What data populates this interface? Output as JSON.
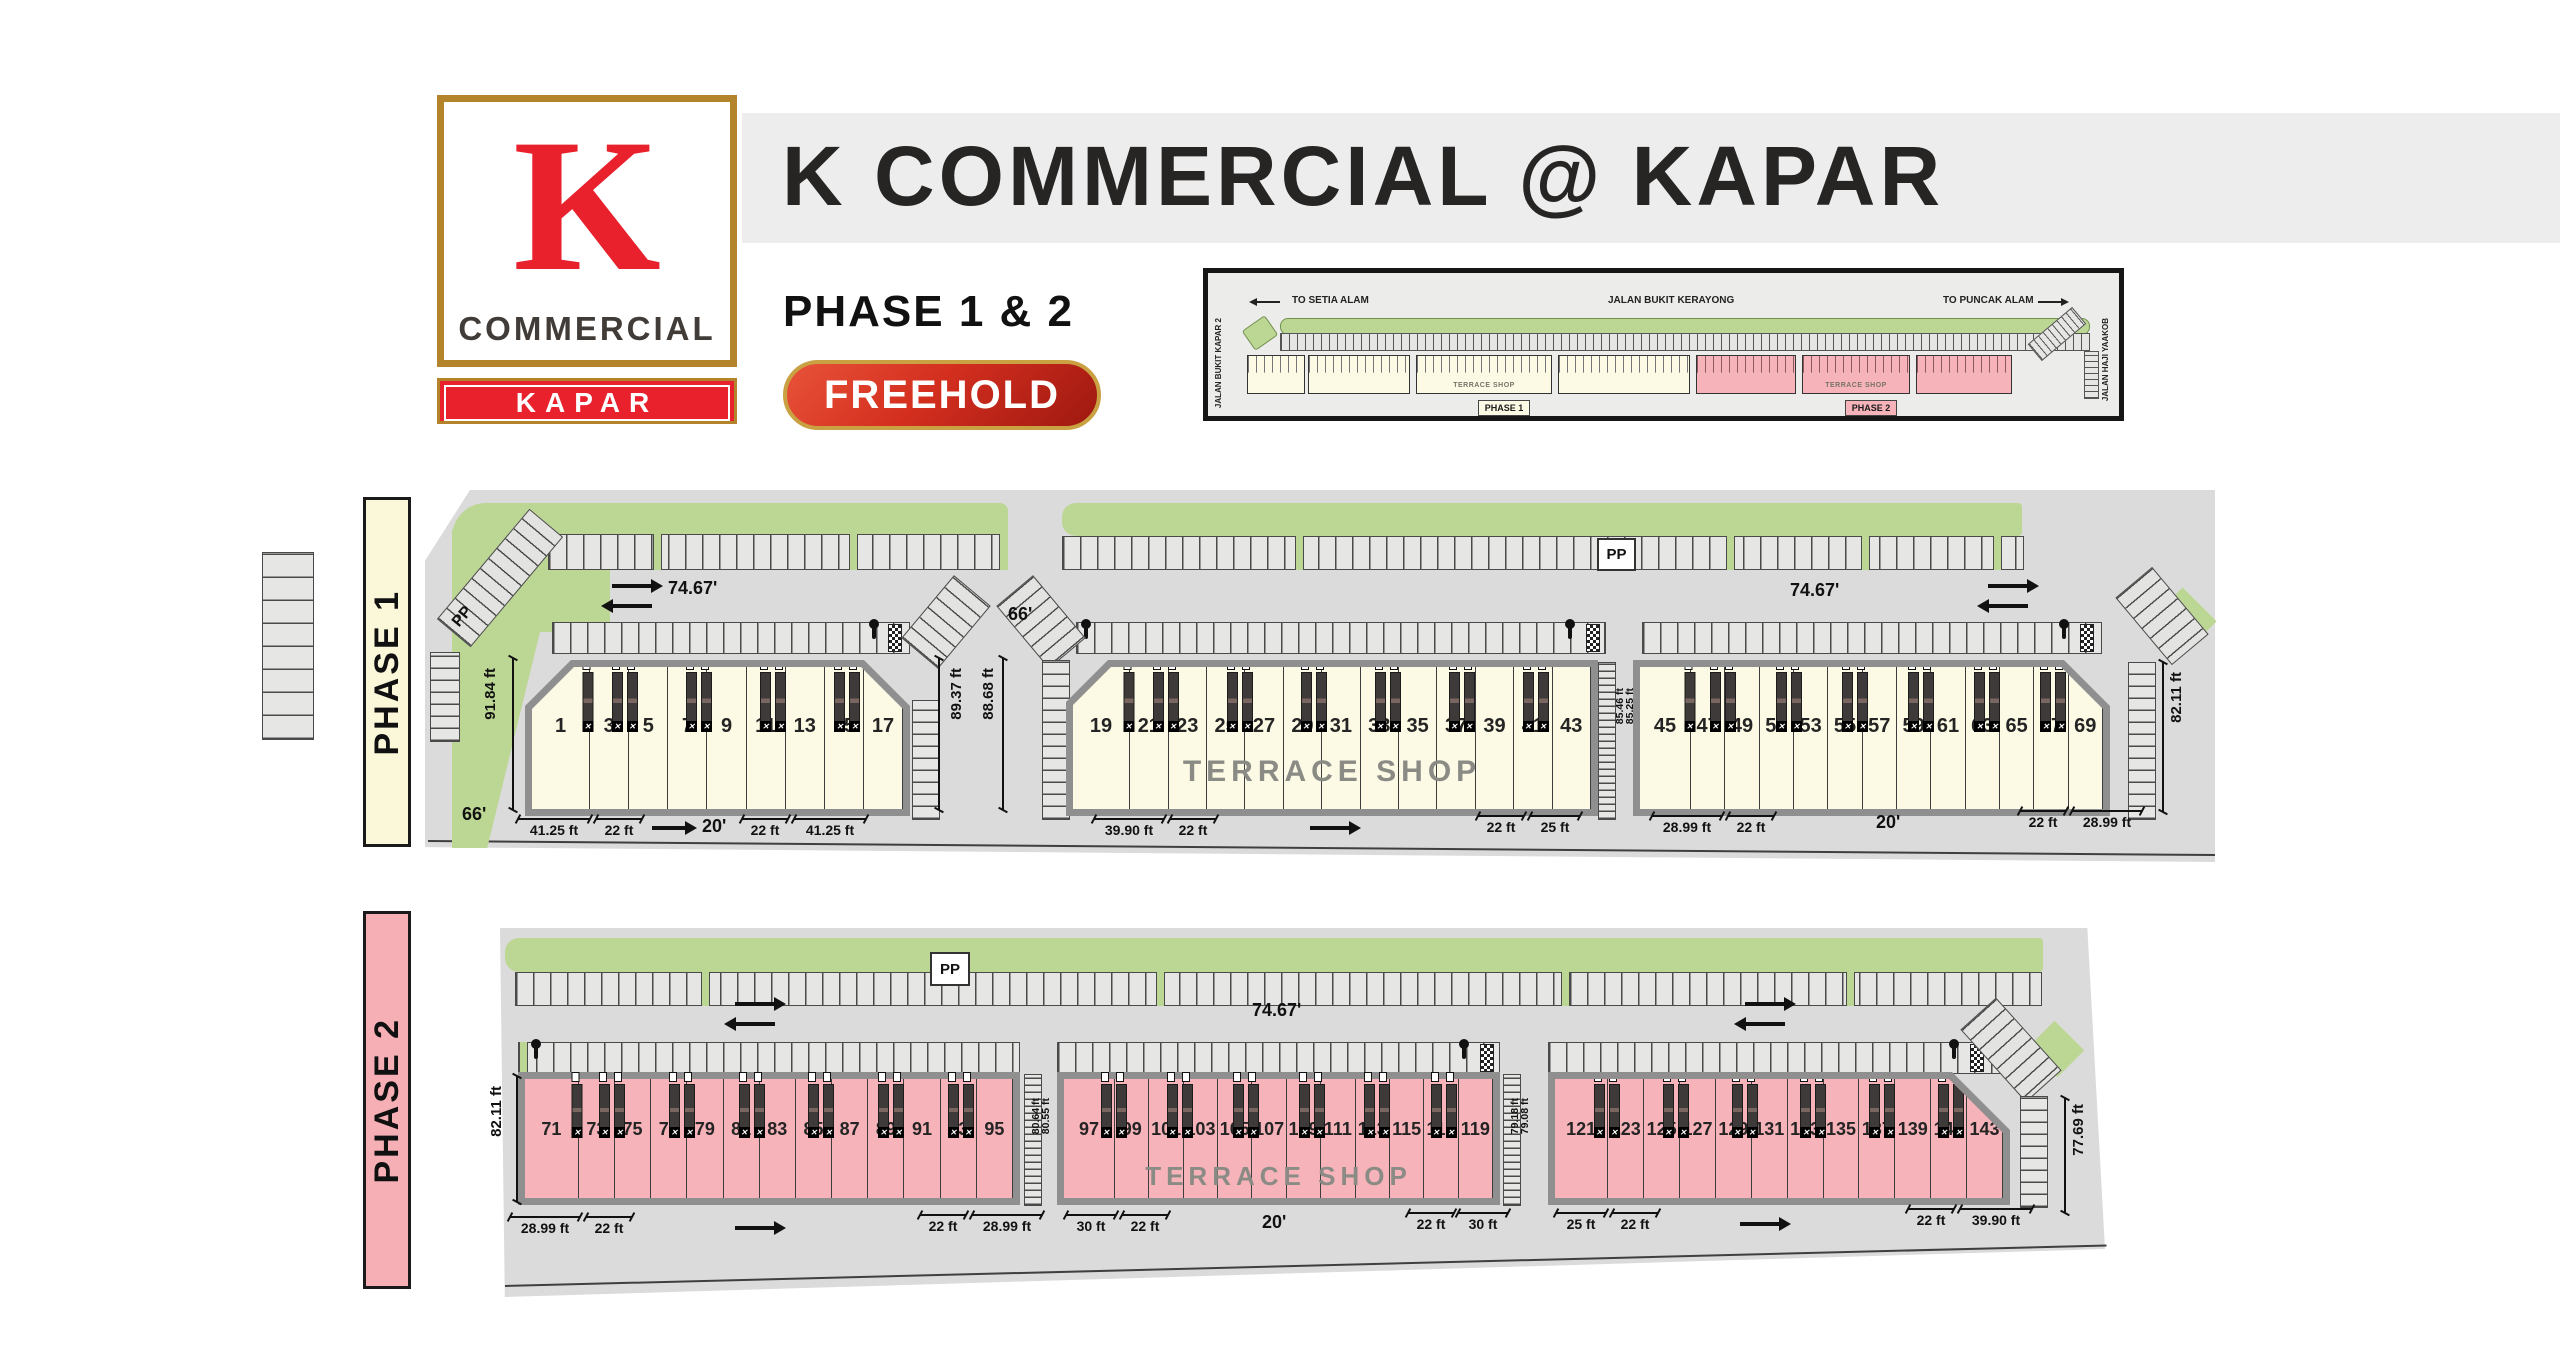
{
  "colors": {
    "red": "#E8212D",
    "gold": "#B3842C",
    "cream": "#FCFAE4",
    "pink": "#F6B3B9",
    "green": "#BCD693",
    "site_gray": "#DBDBDB",
    "band_gray": "#EDEDEE"
  },
  "header": {
    "title": "K COMMERCIAL @ KAPAR",
    "phases": "PHASE 1 & 2",
    "tenure": "FREEHOLD",
    "logo_letter": "K",
    "logo_word": "COMMERCIAL",
    "logo_location": "KAPAR"
  },
  "inset": {
    "to_left": "TO SETIA ALAM",
    "road_top": "JALAN BUKIT KERAYONG",
    "to_right": "TO PUNCAK ALAM",
    "road_left_side": "JALAN BUKIT KAPAR 2",
    "road_right_side": "JALAN HAJI YAAKOB",
    "badge_phase1": "PHASE 1",
    "badge_phase2": "PHASE 2",
    "terrace": "TERRACE SHOP"
  },
  "phase1": {
    "label": "PHASE 1",
    "terrace": "TERRACE SHOP",
    "pp": "PP",
    "road_dim": "74.67'",
    "road_dim2": "74.67'",
    "width66_top": "66'",
    "width66_left": "66'",
    "vdims": {
      "left": "91.84 ft",
      "right_b1": "89.37 ft",
      "left_b2": "88.68 ft",
      "gap_a": "85.46 ft",
      "gap_b": "85.25 ft",
      "right": "82.11 ft"
    },
    "blocks": [
      {
        "lots": [
          "1",
          "3",
          "5",
          "7",
          "9",
          "11",
          "13",
          "15",
          "17"
        ],
        "stairs": [
          [
            1,
            1
          ],
          [
            2,
            2
          ],
          [
            4,
            2
          ],
          [
            6,
            2
          ],
          [
            8,
            2
          ]
        ],
        "dl1": "41.25 ft",
        "dl2": "22 ft",
        "dc": "20'",
        "dr1": "22 ft",
        "dr2": "41.25 ft"
      },
      {
        "lots": [
          "19",
          "21",
          "23",
          "25",
          "27",
          "29",
          "31",
          "33",
          "35",
          "37",
          "39",
          "41",
          "43"
        ],
        "stairs": [
          [
            1,
            1
          ],
          [
            2,
            2
          ],
          [
            4,
            2
          ],
          [
            6,
            2
          ],
          [
            8,
            2
          ],
          [
            10,
            2
          ],
          [
            12,
            2
          ]
        ],
        "dl1": "39.90 ft",
        "dl2": "22 ft",
        "dr1": "22 ft",
        "dr2": "25 ft"
      },
      {
        "lots": [
          "45",
          "47",
          "49",
          "51",
          "53",
          "55",
          "57",
          "59",
          "61",
          "63",
          "65",
          "67",
          "69"
        ],
        "stairs": [
          [
            1,
            1
          ],
          [
            2,
            2
          ],
          [
            4,
            2
          ],
          [
            6,
            2
          ],
          [
            8,
            2
          ],
          [
            10,
            2
          ],
          [
            12,
            2
          ]
        ],
        "dl1": "28.99 ft",
        "dl2": "22 ft",
        "dc": "20'",
        "dr1": "22 ft",
        "dr2": "28.99 ft"
      }
    ]
  },
  "phase2": {
    "label": "PHASE 2",
    "terrace": "TERRACE SHOP",
    "pp": "PP",
    "road_dim": "74.67'",
    "vdims": {
      "left": "82.11 ft",
      "gap1_a": "80.64 ft",
      "gap1_b": "80.55 ft",
      "gap2_a": "79.18 ft",
      "gap2_b": "79.08 ft",
      "right": "77.69 ft"
    },
    "blocks": [
      {
        "lots": [
          "71",
          "73",
          "75",
          "77",
          "79",
          "81",
          "83",
          "85",
          "87",
          "89",
          "91",
          "93",
          "95"
        ],
        "stairs": [
          [
            1,
            1
          ],
          [
            2,
            2
          ],
          [
            4,
            2
          ],
          [
            6,
            2
          ],
          [
            8,
            2
          ],
          [
            10,
            2
          ],
          [
            12,
            2
          ]
        ],
        "dl1": "28.99 ft",
        "dl2": "22 ft",
        "dr1": "22 ft",
        "dr2": "28.99 ft"
      },
      {
        "lots": [
          "97",
          "99",
          "101",
          "103",
          "105",
          "107",
          "109",
          "111",
          "113",
          "115",
          "117",
          "119"
        ],
        "stairs": [
          [
            1,
            2
          ],
          [
            3,
            2
          ],
          [
            5,
            2
          ],
          [
            7,
            2
          ],
          [
            9,
            2
          ],
          [
            11,
            2
          ]
        ],
        "dl1": "30 ft",
        "dl2": "22 ft",
        "dc": "20'",
        "dr1": "22 ft",
        "dr2": "30 ft"
      },
      {
        "lots": [
          "121",
          "123",
          "125",
          "127",
          "129",
          "131",
          "133",
          "135",
          "137",
          "139",
          "141",
          "143"
        ],
        "stairs": [
          [
            1,
            2
          ],
          [
            3,
            2
          ],
          [
            5,
            2
          ],
          [
            7,
            2
          ],
          [
            9,
            2
          ],
          [
            11,
            2
          ]
        ],
        "dl1": "25 ft",
        "dl2": "22 ft",
        "dr1": "22 ft",
        "dr2": "39.90 ft"
      }
    ]
  }
}
